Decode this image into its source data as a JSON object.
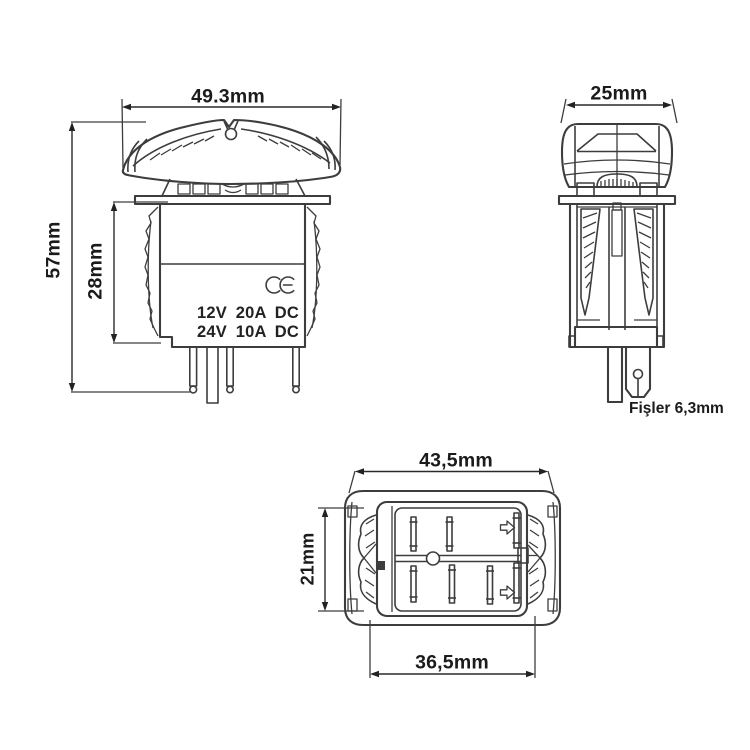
{
  "drawing": {
    "front_view": {
      "width_label": "49.3mm",
      "height_label": "57mm",
      "body_height_label": "28mm",
      "rating_line_1": "12V 20A DC",
      "rating_line_2": "24V 10A DC",
      "ce_mark": "CE"
    },
    "side_view": {
      "width_label": "25mm",
      "terminals_label": "Fişler 6,3mm"
    },
    "bottom_view": {
      "width_label": "43,5mm",
      "height_label": "21mm",
      "inner_width_label": "36,5mm"
    },
    "colors": {
      "line": "#3d3d3d",
      "dimension": "#222222",
      "text": "#1b1b1b",
      "background": "#ffffff"
    }
  }
}
